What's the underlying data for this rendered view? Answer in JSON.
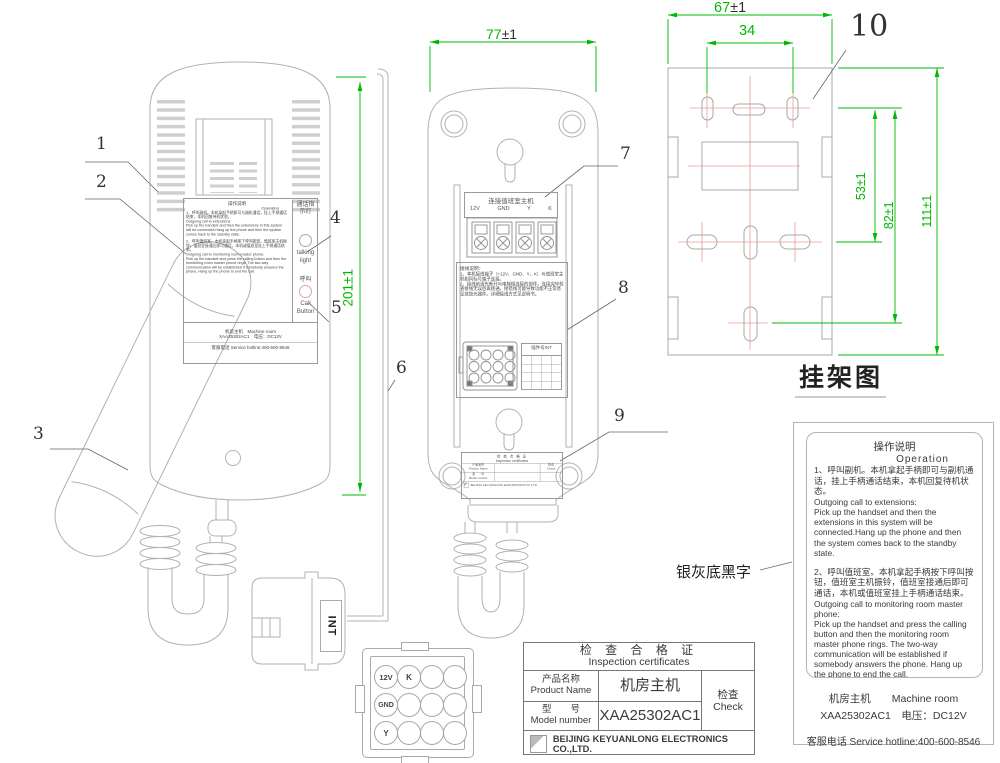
{
  "callouts": {
    "c1": "1",
    "c2": "2",
    "c3": "3",
    "c4": "4",
    "c5": "5",
    "c6": "6",
    "c7": "7",
    "c8": "8",
    "c9": "9",
    "c10": "10"
  },
  "dims": {
    "front_height": "201±1",
    "rear_w_num": "77",
    "rear_w_tol": "±1",
    "bracket_w_num": "67",
    "bracket_w_tol": "±1",
    "bracket_inner": "34",
    "v53": "53±1",
    "v82": "82±1",
    "v111": "111±1"
  },
  "captions": {
    "bracket": "挂架图",
    "note": "银灰底黑字"
  },
  "front": {
    "indicator_zh": "通话指示灯",
    "indicator_en": "talking light",
    "call_zh": "呼叫",
    "call_en": "Call Button"
  },
  "ops": {
    "title_zh": "操作说明",
    "title_en": "Operation",
    "p1_zh": "1、呼叫副机。本机拿起手柄即可与副机通话，挂上手柄通话结束，本机回复待机状态。",
    "p1_head": "Outgoing call to extensions:",
    "p1_en": "Pick up the handset and then the extensions in this system will be connected.Hang up the phone and then the system comes back to the standby state.",
    "p2_zh": "2、呼叫值班室。本机拿起手柄按下呼叫按钮，值班室主机振铃，值班室接通后即可通话，本机或值班室挂上手柄通话结束。",
    "p2_head": "Outgoing call to monitoring room master phone:",
    "p2_en": "Pick up the handset and press the calling button and then the monitoring room master phone rings. The two-way communication will be established if somebody answers the phone. Hang up the phone to end the call."
  },
  "product": {
    "name_zh": "机房主机",
    "name_en": "Machine room",
    "model": "XAA25302AC1",
    "voltage": "电压：DC12V",
    "hotline": "客服电话 Service hotline:400-600-8546"
  },
  "rear": {
    "terminal_title": "连接值班室主机",
    "pins": [
      "12V",
      "GND",
      "Y",
      "K"
    ],
    "wiring_title": "接线说明：",
    "wiring_1": "1、本机接线端子（+12V、GND、Y、K）与值班室主机相同标号端子连接。",
    "wiring_2": "2、接线前请先断开与电梯相连接的部件，连接完毕检查接线无误后再接通。接错线可能导致功能不正常甚至烧毁元器件。详细接线方式见说明书。",
    "connector_no": "插件号INT"
  },
  "cert": {
    "title_zh": "检 查 合 格 证",
    "title_en": "Inspection certificates",
    "product_zh": "产品名称",
    "product_en": "Product Name",
    "model_zh": "型　　号",
    "model_en": "Model number",
    "check_zh": "检查",
    "check_en": "Check",
    "company": "BEIJING KEYUANLONG ELECTRONICS CO.,LTD."
  },
  "conn": {
    "p1": "12V",
    "p2": "K",
    "p3": "GND",
    "p4": "Y",
    "int_label": "INT"
  },
  "colors": {
    "dim_green": "#00b800",
    "centerline_red": "#f09898",
    "line_gray": "#b2b2b2"
  }
}
